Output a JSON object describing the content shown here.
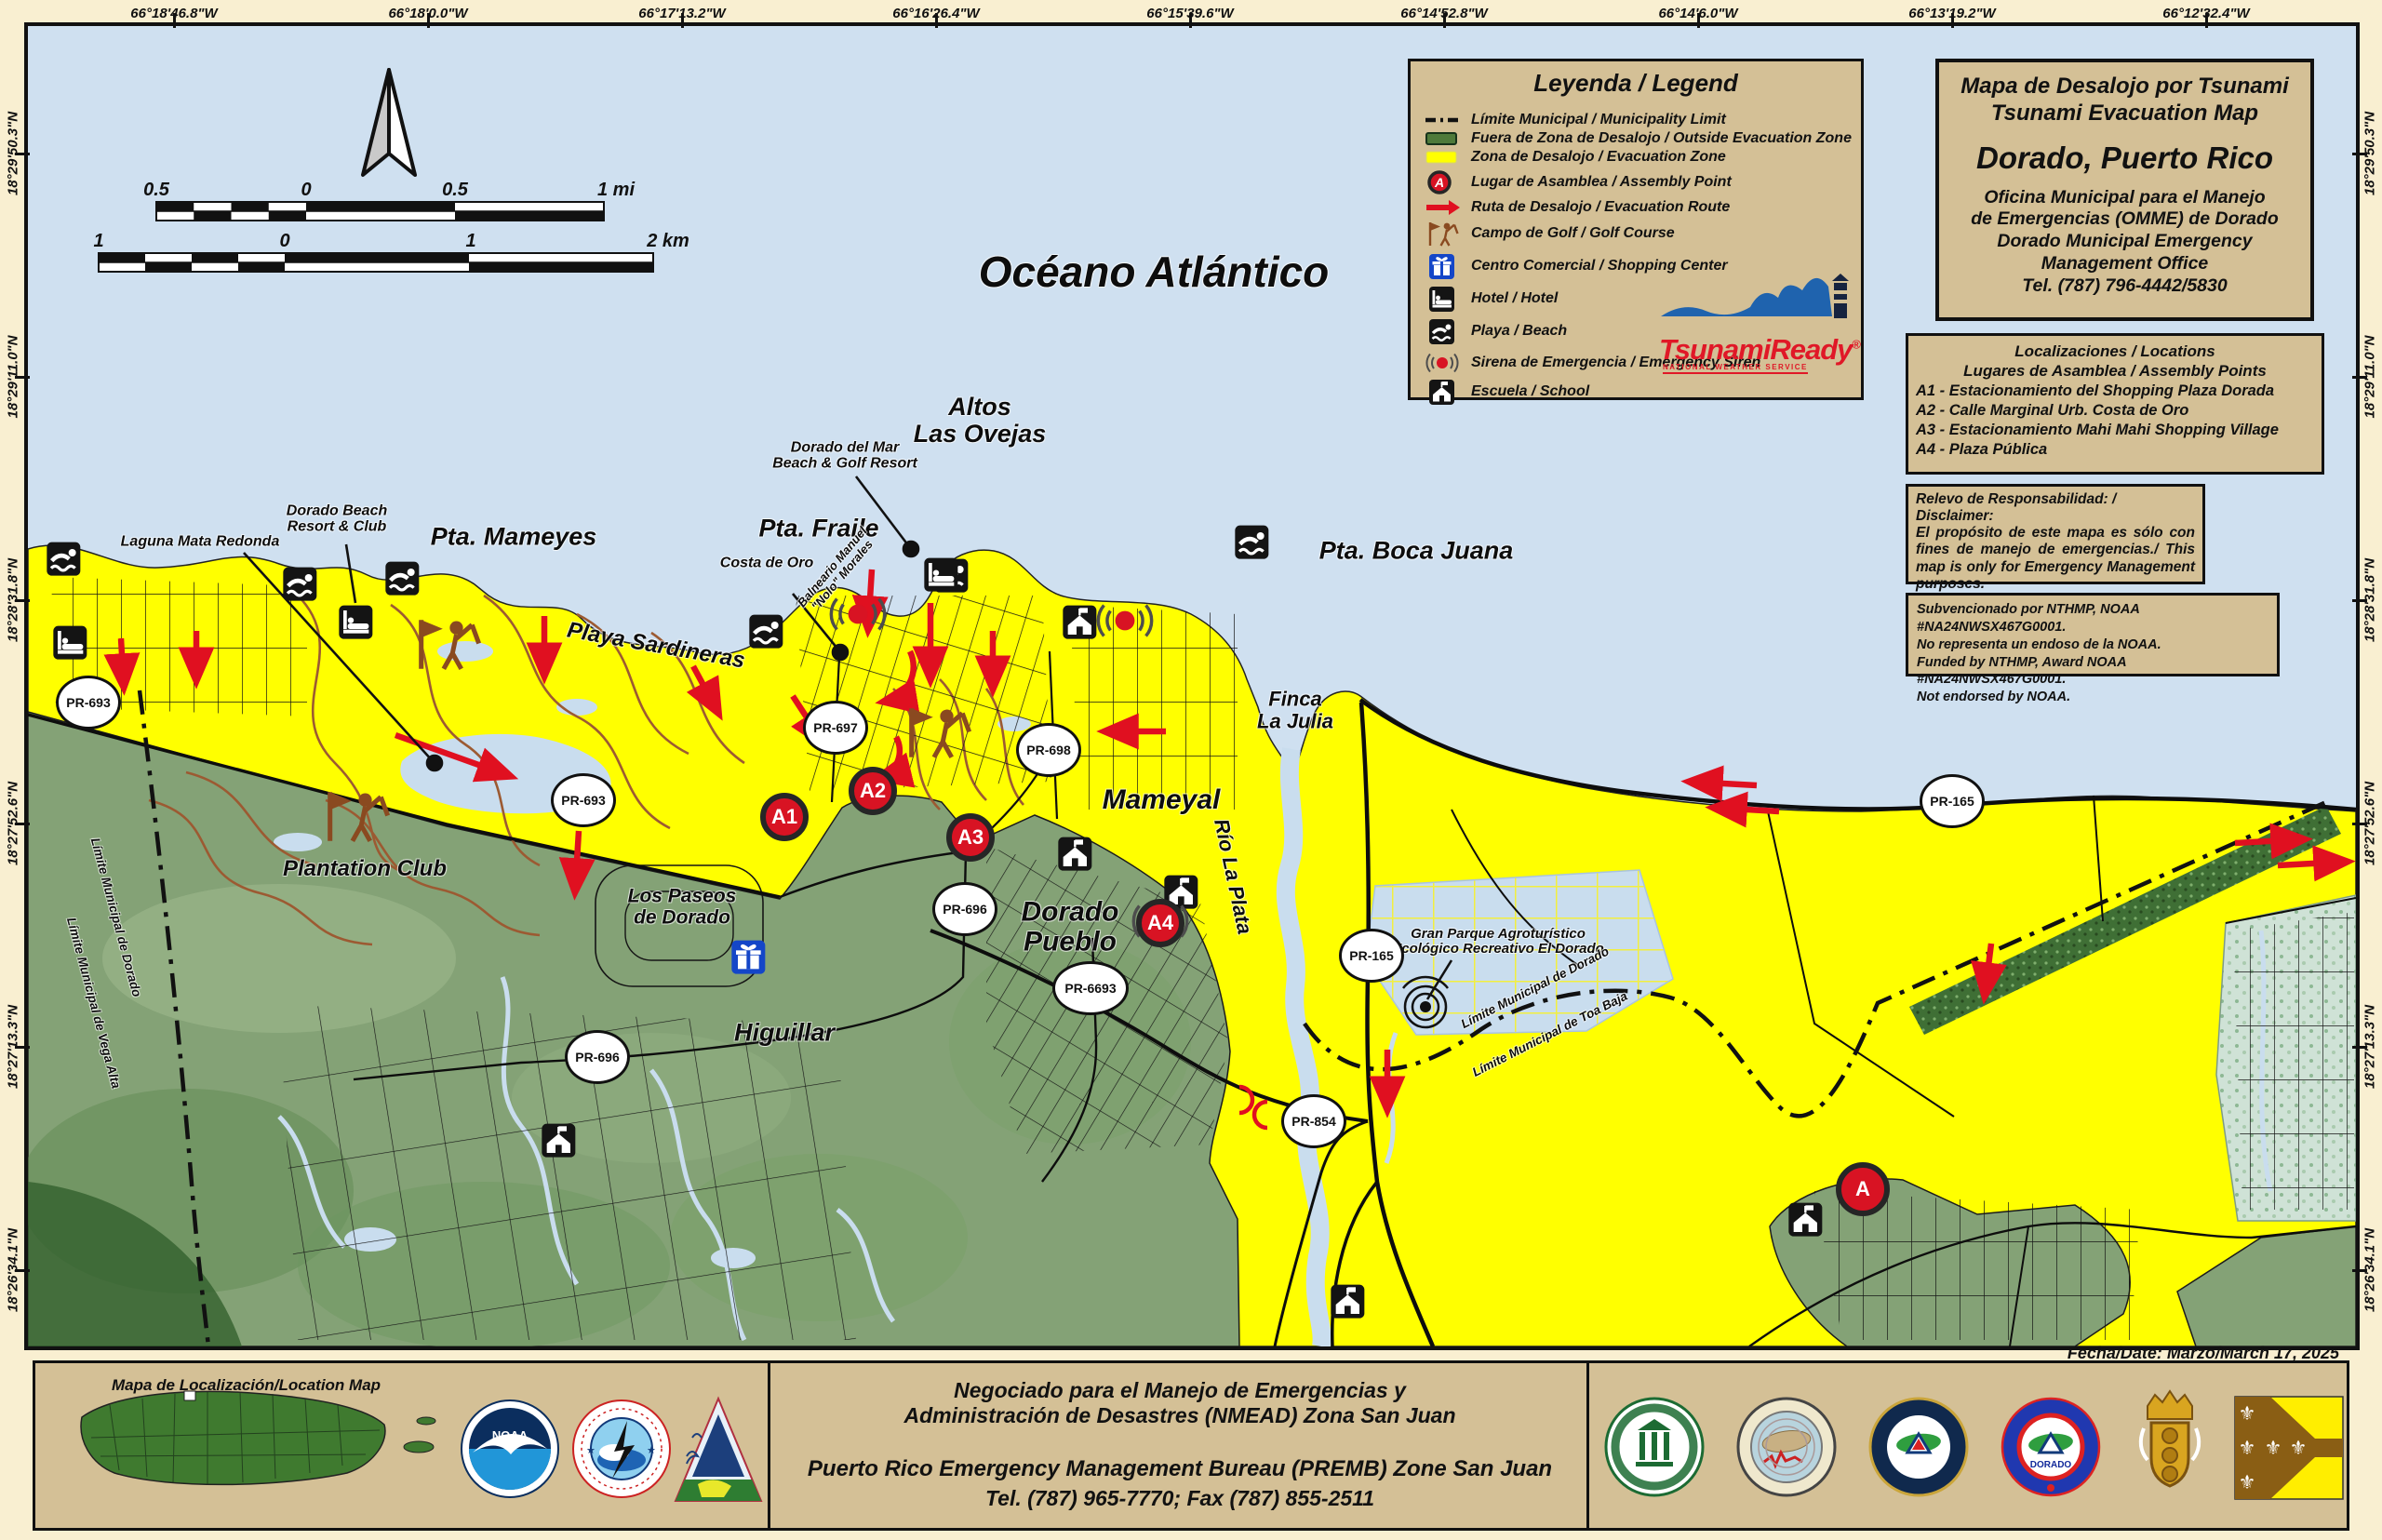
{
  "coordinates": {
    "top": [
      "66°18'46.8\"W",
      "66°18'0.0\"W",
      "66°17'13.2\"W",
      "66°16'26.4\"W",
      "66°15'39.6\"W",
      "66°14'52.8\"W",
      "66°14'6.0\"W",
      "66°13'19.2\"W",
      "66°12'32.4\"W"
    ],
    "side": [
      "18°29'50.3\"N",
      "18°29'11.0\"N",
      "18°28'31.8\"N",
      "18°27'52.6\"N",
      "18°27'13.3\"N",
      "18°26'34.1\"N"
    ]
  },
  "scalebar": {
    "miles_labels": [
      "0.5",
      "0",
      "0.5",
      "1 mi"
    ],
    "km_labels": [
      "1",
      "0",
      "1",
      "2 km"
    ]
  },
  "legend": {
    "title": "Leyenda / Legend",
    "items": [
      {
        "icon": "municipal-limit",
        "label": "Límite Municipal / Municipality Limit"
      },
      {
        "icon": "outside-zone",
        "label": "Fuera de Zona de Desalojo / Outside Evacuation Zone"
      },
      {
        "icon": "evacuation-zone",
        "label": "Zona de Desalojo / Evacuation Zone"
      },
      {
        "icon": "assembly-point",
        "label": "Lugar de Asamblea / Assembly Point"
      },
      {
        "icon": "evacuation-route",
        "label": "Ruta de Desalojo / Evacuation Route"
      },
      {
        "icon": "golf-course",
        "label": "Campo de Golf / Golf Course"
      },
      {
        "icon": "shopping-center",
        "label": "Centro Comercial / Shopping Center"
      },
      {
        "icon": "hotel",
        "label": "Hotel / Hotel"
      },
      {
        "icon": "beach",
        "label": "Playa / Beach"
      },
      {
        "icon": "emergency-siren",
        "label": "Sirena de Emergencia / Emergency Siren"
      },
      {
        "icon": "school",
        "label": "Escuela / School"
      }
    ]
  },
  "tsunami_ready": {
    "brand": "TsunamiReady",
    "reg": "®",
    "tagline": "NATIONAL WEATHER SERVICE"
  },
  "title_box": {
    "line1": "Mapa de Desalojo por Tsunami",
    "line2": "Tsunami Evacuation Map",
    "city": "Dorado, Puerto Rico",
    "office": "Oficina Municipal para el Manejo\nde Emergencias (OMME) de Dorado\nDorado Municipal Emergency\nManagement Office\nTel. (787) 796-4442/5830"
  },
  "locations_box": {
    "title": "Localizaciones / Locations",
    "subtitle": "Lugares de Asamblea / Assembly Points",
    "items": [
      "A1 - Estacionamiento del Shopping Plaza Dorada",
      "A2 - Calle Marginal Urb. Costa de Oro",
      "A3 - Estacionamiento Mahi Mahi Shopping Village",
      "A4 - Plaza Pública"
    ]
  },
  "disclaimer_box": {
    "title": "Relevo de Responsabilidad: / Disclaimer:",
    "body": "El propósito de este mapa es sólo con fines de manejo de emergencias./ This map is only for Emergency Management purposes."
  },
  "funding_box": {
    "lines": [
      "Subvencionado por NTHMP, NOAA #NA24NWSX467G0001.",
      "No representa un endoso de la NOAA.",
      "Funded by NTHMP, Award NOAA #NA24NWSX467G0001.",
      "Not endorsed by NOAA."
    ]
  },
  "date_label": "Fecha/Date: Marzo/March 17, 2025",
  "map_labels": [
    {
      "text": "Océano Atlántico"
    },
    {
      "text": "Altos\nLas Ovejas"
    },
    {
      "text": "Pta. Fraile"
    },
    {
      "text": "Pta. Mameyes"
    },
    {
      "text": "Pta. Boca Juana"
    },
    {
      "text": "Playa Sardineras"
    },
    {
      "text": "Laguna Mata Redonda"
    },
    {
      "text": "Dorado Beach\nResort & Club"
    },
    {
      "text": "Dorado del Mar\nBeach & Golf Resort"
    },
    {
      "text": "Costa de Oro"
    },
    {
      "text": "Balneario Manuel\n\"Nolo\" Morales"
    },
    {
      "text": "Finca\nLa Julia"
    },
    {
      "text": "Mameyal"
    },
    {
      "text": "Río La Plata"
    },
    {
      "text": "Dorado\nPueblo"
    },
    {
      "text": "Plantation Club"
    },
    {
      "text": "Los Paseos\nde Dorado"
    },
    {
      "text": "Higuillar"
    },
    {
      "text": "Gran Parque Agroturístico\nEcológico Recreativo El Dorado"
    },
    {
      "text": "Límite Municipal de Dorado"
    },
    {
      "text": "Límite Municipal de Toa Baja"
    },
    {
      "text": "Límite Municipal de Dorado"
    },
    {
      "text": "Límite Municipal de Vega Alta"
    }
  ],
  "road_shields": [
    "PR-693",
    "PR-697",
    "PR-693",
    "PR-698",
    "PR-696",
    "PR-6693",
    "PR-696",
    "PR-165",
    "PR-165",
    "PR-854"
  ],
  "assembly_points": [
    "A1",
    "A2",
    "A3",
    "A4",
    "A"
  ],
  "bottom_bar": {
    "location_map_label": "Mapa de Localización/Location Map",
    "lines": [
      "Negociado para el Manejo de Emergencias y",
      "Administración de Desastres (NMEAD) Zona San Juan",
      "Puerto Rico Emergency Management Bureau (PREMB) Zone San Juan",
      "Tel. (787) 965-7770; Fax (787) 855-2511"
    ],
    "logos_left": [
      "noaa-logo",
      "nws-logo",
      "tsunamiready-pyramid-logo"
    ],
    "logos_right": [
      "uprm-seal-logo",
      "red-sismica-logo",
      "nmead-seal-logo",
      "omme-dorado-logo",
      "dorado-coat-of-arms",
      "dorado-flag"
    ]
  },
  "colors": {
    "evacuation_zone": "#ffff00",
    "outside_zone": "#84a276",
    "ocean": "#cfe0f0",
    "panel_tan": "#d4c096",
    "route_red": "#e01020"
  }
}
